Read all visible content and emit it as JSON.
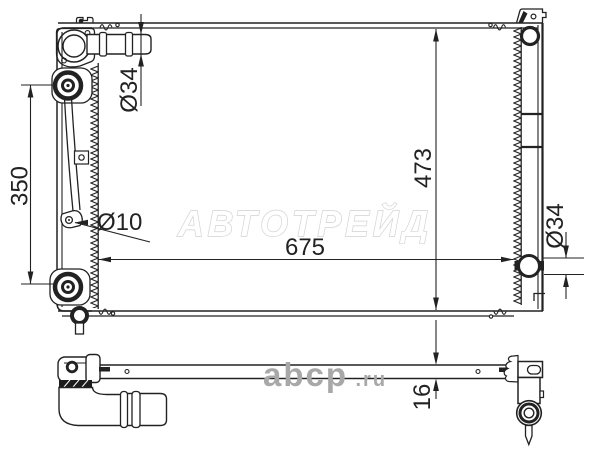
{
  "drawing": {
    "watermark_brand": "АВТОТРЕЙД",
    "watermark_site_name": "abcp",
    "watermark_site_tld": ".ru",
    "dimensions": {
      "mount_span": "350",
      "inlet_diameter": "Ø34",
      "mount_hole_diameter": "Ø10",
      "core_height": "473",
      "core_width": "675",
      "outlet_diameter": "Ø34",
      "core_thickness": "16"
    },
    "colors": {
      "line": "#222222",
      "dimension_text": "#222222",
      "watermark_fill": "#ffffff",
      "watermark_outline": "#d2d2d2",
      "watermark_site_gray": "#a8a8a8",
      "background": "#ffffff"
    }
  }
}
